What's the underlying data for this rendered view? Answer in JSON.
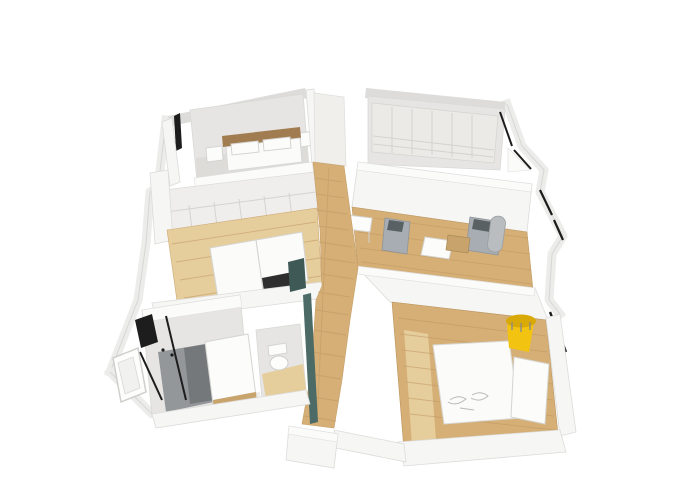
{
  "scene": {
    "type": "3d-floor-plan-render",
    "palette": {
      "background": "#ffffff",
      "wall_face": "#f6f6f5",
      "wall_top": "#dddcda",
      "room_shade": "#e6e5e3",
      "floor_gray": "#dedcd8",
      "wood": "#d5af76",
      "wood_light": "#e6cd9c",
      "wood_line": "#bd9760",
      "headboard_wood": "#a07c50",
      "bed_white": "#fbfbfa",
      "sofa_gray": "#a7adb2",
      "sofa_dark": "#5a6165",
      "metal_gray": "#b9bdc0",
      "accent_yellow": "#f2c411",
      "accent_yellow_dark": "#d9a907",
      "accent_teal": "#4d6b66",
      "accent_teal_dark": "#3f5a56",
      "shower_gray": "#94979a",
      "shower_dark": "#75787b",
      "tub_wood": "#c8a36c",
      "dark_fixture": "#1d1d1d",
      "tv_dark": "#2e2e2e"
    },
    "rooms": [
      {
        "id": "master-bedroom",
        "label": "bedroom-top-left",
        "contents": "double bed with wooden headboard, two pillows, nightstands, window"
      },
      {
        "id": "walk-in-closet",
        "label": "wardrobe-room-top-right",
        "contents": "wardrobe units with drawers, open door"
      },
      {
        "id": "bedroom-2",
        "label": "bedroom-middle-left",
        "contents": "built-in wardrobe wall, white double bed, dark tv bench, wood floor"
      },
      {
        "id": "living-area",
        "label": "living-room-middle-right",
        "contents": "desk, two gray armchairs, white coffee table, wood cabinet, boiler cylinder, windows"
      },
      {
        "id": "bathroom",
        "label": "bathroom-bottom-left",
        "contents": "walk-in shower with glass, black radiator, bathtub with wood panel, window"
      },
      {
        "id": "wc",
        "label": "toilet-room-bottom-center",
        "contents": "toilet, teal cabinet wall"
      },
      {
        "id": "bedroom-3",
        "label": "bedroom-bottom-right",
        "contents": "white double bed, yellow tub chair, white dresser, window, wood floor"
      },
      {
        "id": "hallway",
        "label": "hallway-center",
        "contents": "wood plank flooring connecting all rooms"
      }
    ],
    "furniture": [
      {
        "id": "bed-master",
        "color": "#fbfbfa"
      },
      {
        "id": "bed-2",
        "color": "#fbfbfa"
      },
      {
        "id": "bed-3",
        "color": "#fbfbfa"
      },
      {
        "id": "yellow-chair",
        "color": "#f2c411"
      },
      {
        "id": "armchairs",
        "color": "#a7adb2"
      },
      {
        "id": "teal-cabinet",
        "color": "#4d6b66"
      },
      {
        "id": "shower-floor",
        "color": "#94979a"
      },
      {
        "id": "tv-bench",
        "color": "#2e2e2e"
      }
    ]
  }
}
